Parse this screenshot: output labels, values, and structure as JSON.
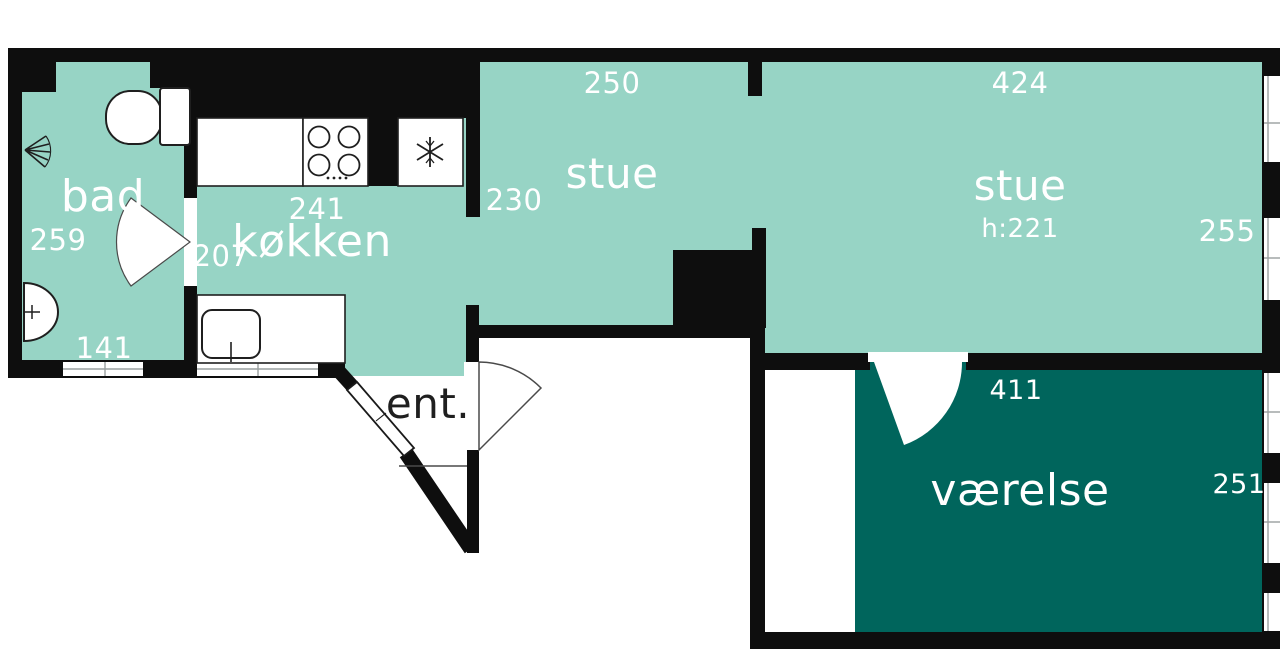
{
  "meta": {
    "type": "floor-plan",
    "language": "da"
  },
  "colors": {
    "background": "#ffffff",
    "wall": "#0e0e0e",
    "room_light": "#97d4c5",
    "room_dark": "#00655c",
    "label_light": "#ffffff",
    "label_dark": "#1f1f1f"
  },
  "rooms": {
    "bad": {
      "label": "bad",
      "dim_side": "259",
      "dim_bottom": "141"
    },
    "kokken": {
      "label": "køkken",
      "dim_top": "241",
      "dim_side": "207"
    },
    "stue_small": {
      "label": "stue",
      "dim_top": "250",
      "dim_side": "230"
    },
    "stue_large": {
      "label": "stue",
      "height_note": "h:221",
      "dim_top": "424",
      "dim_side": "255"
    },
    "vaerelse": {
      "label": "værelse",
      "dim_top": "411",
      "dim_side": "251"
    },
    "entre": {
      "label": "ent."
    }
  },
  "fixtures": {
    "toilet": "toilet-icon",
    "shower": "shower-head-icon",
    "washbasin": "washbasin-icon",
    "hob": "stove-hob-icon",
    "freezer": "snowflake-icon",
    "kitchen_sink": "kitchen-sink-icon"
  }
}
